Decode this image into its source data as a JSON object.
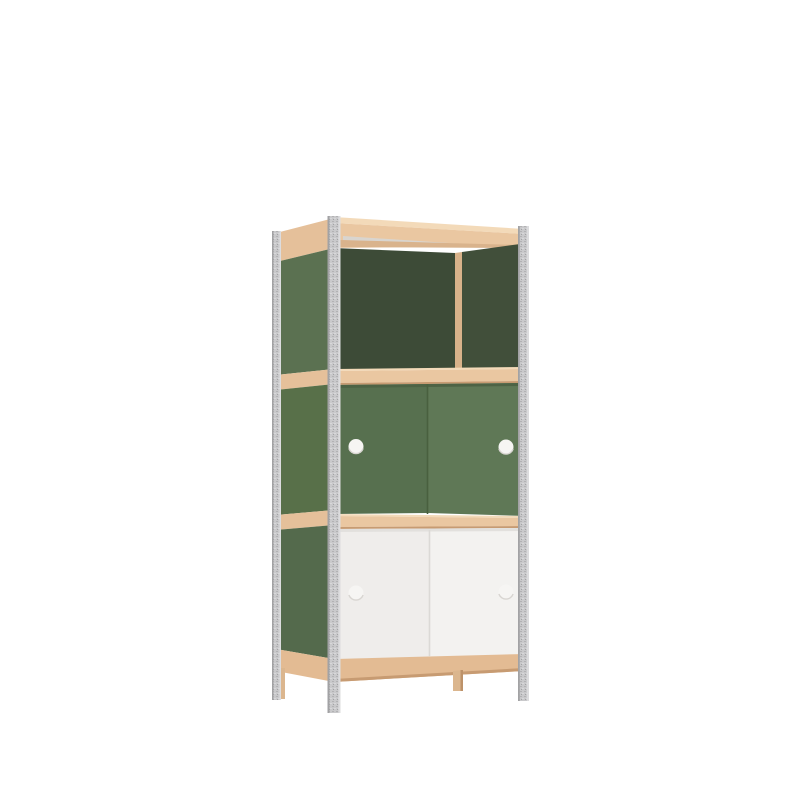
{
  "page": {
    "background": "#ffffff"
  },
  "product": {
    "name": "modular-shelving-cabinet-render",
    "sections": [
      {
        "label": "open-top-compartment"
      },
      {
        "label": "middle-green-sliding-doors"
      },
      {
        "label": "bottom-white-sliding-doors"
      }
    ],
    "colors": {
      "background": "#ffffff",
      "metal": "#c9c9cb",
      "metalSpeckleDark": "#b2b2b4",
      "metalSpeckleLight": "#d8d8da",
      "metalEdgeDark": "#a2a2a4",
      "metalEdgeLight": "#dcdcde",
      "woodLight": "#eac7a1",
      "woodHighlight": "#f3dab9",
      "woodShadow": "#c79b72",
      "woodInner": "#d9b38c",
      "woodDivider": "#d8b28a",
      "woodApron": "#e3bb93",
      "woodSideBand": "#e5c09a",
      "woodLeg": "#dbb68e",
      "woodLegShade": "#bd9269",
      "greenSideUpper": "#5b7151",
      "greenSideMid": "#587049",
      "greenSideLower": "#546a4c",
      "greenInteriorLeft": "#3d4b37",
      "greenInteriorRight": "#414f3a",
      "greenDoorLeft": "#57704f",
      "greenDoorRight": "#5f7856",
      "greenDoorSeam": "#49603f",
      "greenDoorTopShade": "#4d6345",
      "whiteDoorLeft": "#efedeb",
      "whiteDoorRight": "#f3f2f0",
      "whiteDoorSeam": "#dbd9d6",
      "whiteDoorTopShade": "#e2e0dd",
      "insetGray": "#d9d5cf",
      "handle": "#f6f5f3",
      "handleRim": "#d8d5d1"
    }
  }
}
